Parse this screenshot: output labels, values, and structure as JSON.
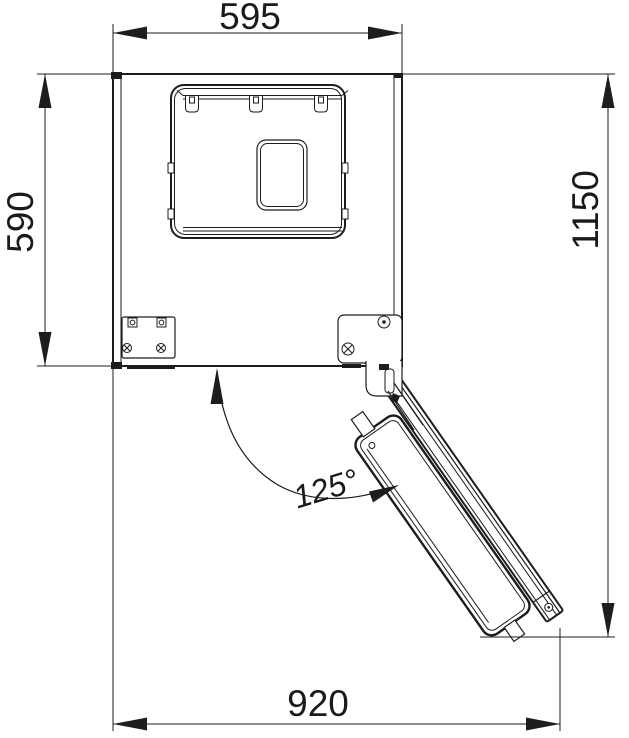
{
  "drawing": {
    "title": "appliance-top-view-dimension-drawing",
    "dimensions": {
      "width": "595",
      "depth": "590",
      "total_depth_door_open": "1150",
      "width_door_open": "920",
      "door_angle": "125°"
    },
    "colors": {
      "line": "#1d1d1b",
      "dimension_text": "#1a1a1a",
      "angle_text": "#7d7d7d",
      "background": "#ffffff"
    }
  }
}
